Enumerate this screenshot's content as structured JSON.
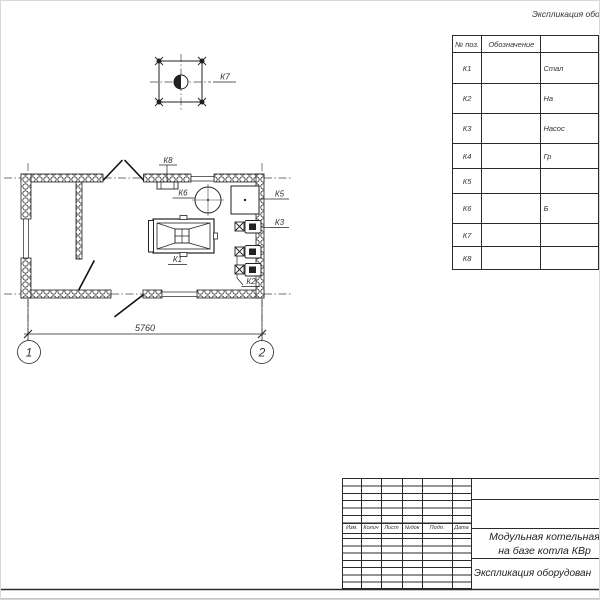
{
  "colors": {
    "line": "#2a2a2a",
    "hatch": "#3a3a3a",
    "text": "#333333",
    "frame_shadow": "#c4c4c4"
  },
  "spec_table": {
    "title": "Экспликация обору",
    "columns": [
      "№ поз.",
      "Обозначение"
    ],
    "rows": [
      {
        "pos": "К1",
        "name": "Стал"
      },
      {
        "pos": "К2",
        "name": "На"
      },
      {
        "pos": "К3",
        "name": "Насос"
      },
      {
        "pos": "К4",
        "name": "Гр"
      },
      {
        "pos": "К5",
        "name": ""
      },
      {
        "pos": "К6",
        "name": "Б"
      },
      {
        "pos": "К7",
        "name": ""
      },
      {
        "pos": "К8",
        "name": ""
      }
    ]
  },
  "plan": {
    "labels": {
      "k1": "К1",
      "k2": "К2",
      "k3": "К3",
      "k5": "К5",
      "k6": "К6",
      "k7": "К7",
      "k8": "К8"
    },
    "dimension": "5760",
    "axis_1": "1",
    "axis_2": "2"
  },
  "title_block": {
    "header_cells": [
      "Изм.",
      "Колич",
      "Лист",
      "№док",
      "Подп.",
      "Дата"
    ],
    "doc_name_line1": "Модульная котельная",
    "doc_name_line2": "на базе котла КВр",
    "sheet_name": "Экспликация оборудован"
  }
}
